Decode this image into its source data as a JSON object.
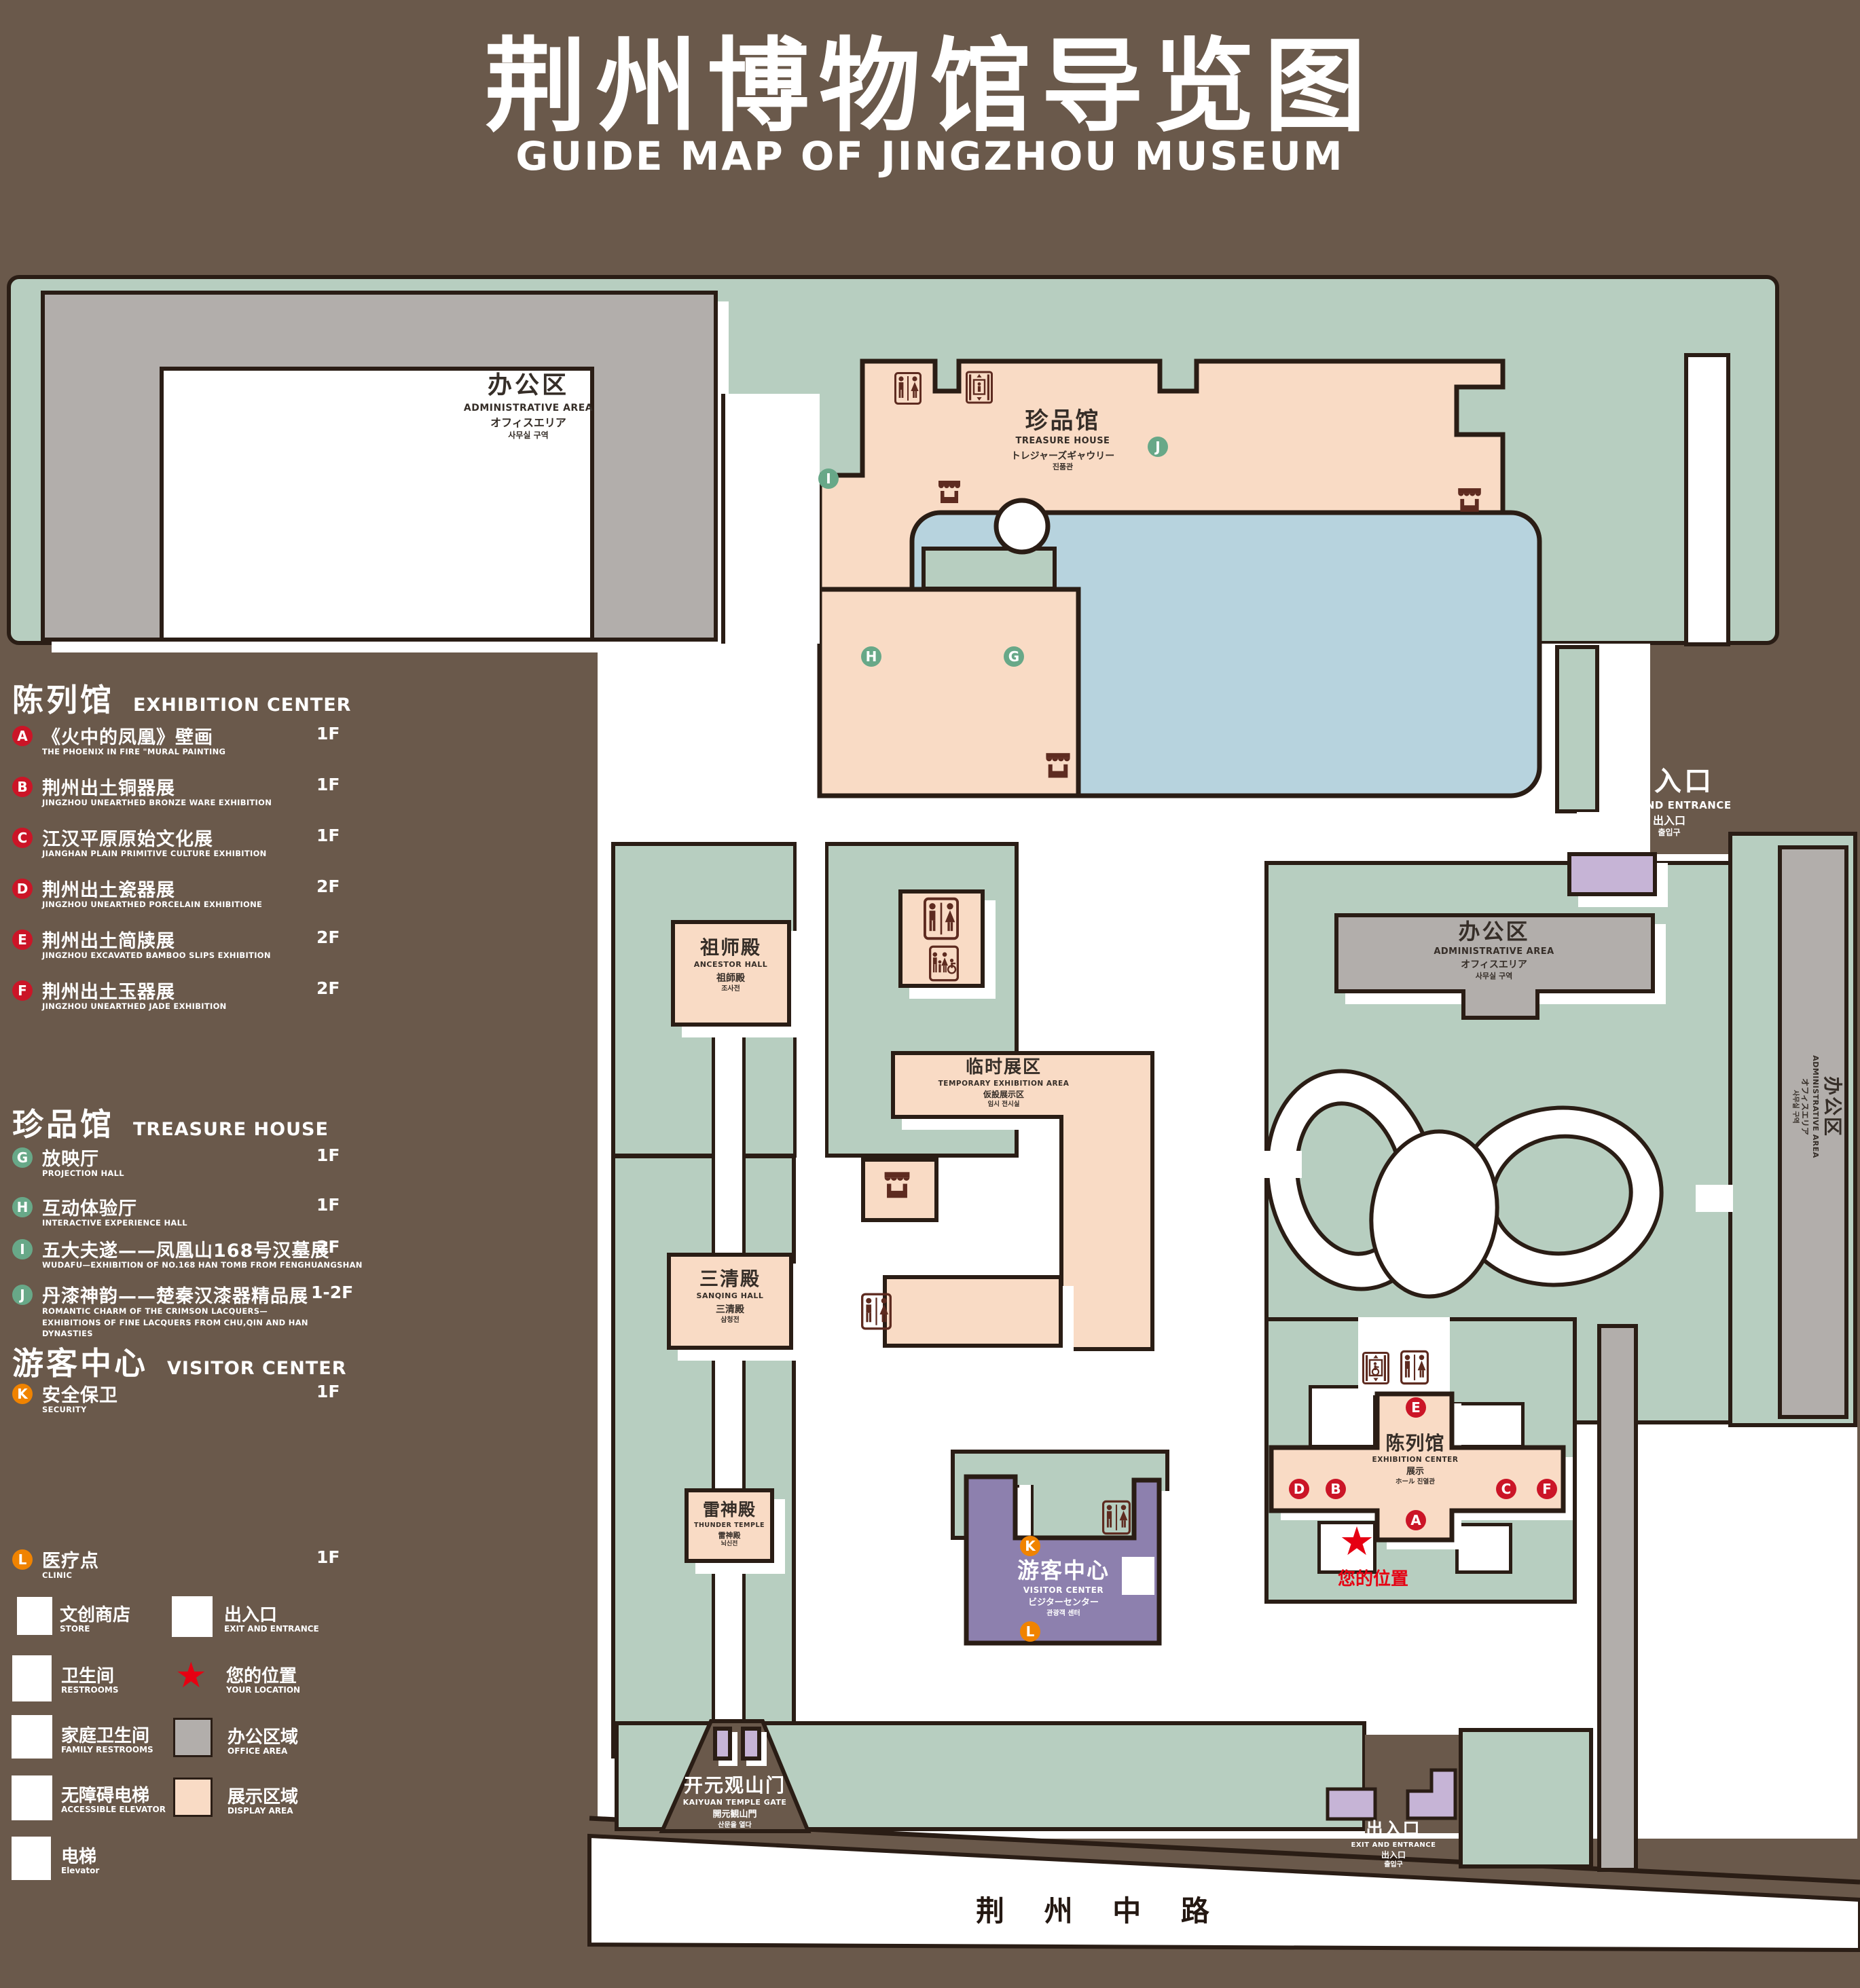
{
  "title": {
    "zh": "荆州博物馆导览图",
    "en": "GUIDE MAP OF JINGZHOU MUSEUM"
  },
  "colors": {
    "background": "#6a594b",
    "grounds_green": "#b7cec0",
    "display_area_pink": "#f9dbc5",
    "office_area_gray": "#b2aeab",
    "pond_blue": "#b7d3de",
    "visitor_center_purple": "#8d80ae",
    "gate_purple": "#c6b4d6",
    "marker_red": "#cb1527",
    "marker_green": "#68a888",
    "marker_orange": "#f08300",
    "icon_maroon": "#5e2b20",
    "location_star_red": "#e60012",
    "outline": "#2a1d15"
  },
  "legend": {
    "sections": [
      {
        "title_zh": "陈列馆",
        "title_en": "EXHIBITION CENTER",
        "items": [
          {
            "id": "A",
            "zh": "《火中的凤凰》壁画",
            "en": "THE PHOENIX IN FIRE \"MURAL PAINTING",
            "floor": "1F"
          },
          {
            "id": "B",
            "zh": "荆州出土铜器展",
            "en": "JINGZHOU UNEARTHED BRONZE WARE EXHIBITION",
            "floor": "1F"
          },
          {
            "id": "C",
            "zh": "江汉平原原始文化展",
            "en": "JIANGHAN PLAIN PRIMITIVE CULTURE EXHIBITION",
            "floor": "1F"
          },
          {
            "id": "D",
            "zh": "荆州出土瓷器展",
            "en": "JINGZHOU UNEARTHED PORCELAIN EXHIBITIONE",
            "floor": "2F"
          },
          {
            "id": "E",
            "zh": "荆州出土简牍展",
            "en": "JINGZHOU EXCAVATED BAMBOO SLIPS EXHIBITION",
            "floor": "2F"
          },
          {
            "id": "F",
            "zh": "荆州出土玉器展",
            "en": "JINGZHOU UNEARTHED JADE EXHIBITION",
            "floor": "2F"
          }
        ]
      },
      {
        "title_zh": "珍品馆",
        "title_en": "TREASURE HOUSE",
        "items": [
          {
            "id": "G",
            "zh": "放映厅",
            "en": "PROJECTION HALL",
            "floor": "1F"
          },
          {
            "id": "H",
            "zh": "互动体验厅",
            "en": "INTERACTIVE EXPERIENCE HALL",
            "floor": "1F"
          },
          {
            "id": "I",
            "zh": "五大夫遂——凤凰山168号汉墓展",
            "en": "WUDAFU—EXHIBITION OF NO.168 HAN TOMB FROM FENGHUANGSHAN",
            "floor": "2F"
          },
          {
            "id": "J",
            "zh": "丹漆神韵——楚秦汉漆器精品展",
            "en": "ROMANTIC CHARM OF THE CRIMSON LACQUERS—EXHIBITIONS OF FINE LACQUERS FROM CHU,QIN AND HAN DYNASTIES",
            "floor": "1-2F"
          }
        ]
      },
      {
        "title_zh": "游客中心",
        "title_en": "VISITOR CENTER",
        "items": [
          {
            "id": "K",
            "zh": "安全保卫",
            "en": "SECURITY",
            "floor": "1F"
          },
          {
            "id": "L",
            "zh": "医疗点",
            "en": "CLINIC",
            "floor": "1F"
          }
        ]
      }
    ],
    "symbols": [
      {
        "zh": "文创商店",
        "en": "STORE",
        "icon": "store-icon"
      },
      {
        "zh": "卫生间",
        "en": "RESTROOMS",
        "icon": "restroom-icon"
      },
      {
        "zh": "家庭卫生间",
        "en": "FAMILY RESTROOMS",
        "icon": "family-restroom-icon"
      },
      {
        "zh": "无障碍电梯",
        "en": "ACCESSIBLE ELEVATOR",
        "icon": "accessible-elevator-icon"
      },
      {
        "zh": "电梯",
        "en": "Elevator",
        "icon": "elevator-icon"
      },
      {
        "zh": "出入口",
        "en": "EXIT AND ENTRANCE",
        "icon": "exit-icon"
      },
      {
        "zh": "您的位置",
        "en": "YOUR LOCATION",
        "icon": "location-star-icon"
      },
      {
        "zh": "办公区域",
        "en": "OFFICE AREA",
        "icon": "office-swatch"
      },
      {
        "zh": "展示区域",
        "en": "DISPLAY AREA",
        "icon": "display-swatch"
      }
    ]
  },
  "map": {
    "admin": {
      "zh": "办公区",
      "en": "ADMINISTRATIVE AREA",
      "ja": "オフィスエリア",
      "ko": "사무실 구역"
    },
    "treasure": {
      "zh": "珍品馆",
      "en": "TREASURE HOUSE",
      "ja": "トレジャーズギャウリー",
      "ko": "진품관"
    },
    "exit": {
      "zh": "出入口",
      "en": "EXIT AND ENTRANCE",
      "zh2": "出入口",
      "ko": "출입구"
    },
    "ancestor": {
      "zh": "祖师殿",
      "en": "ANCESTOR HALL",
      "ja": "祖師殿",
      "ko": "조사전"
    },
    "temp": {
      "zh": "临时展区",
      "en": "TEMPORARY EXHIBITION AREA",
      "ja": "仮設展示区",
      "ko": "임시 전시실"
    },
    "sanqing": {
      "zh": "三清殿",
      "en": "SANQING HALL",
      "ja": "三清殿",
      "ko": "삼청전"
    },
    "thunder": {
      "zh": "雷神殿",
      "en": "THUNDER TEMPLE",
      "ja": "雷神殿",
      "ko": "뇌신전"
    },
    "visitor": {
      "zh": "游客中心",
      "en": "VISITOR CENTER",
      "ja": "ビジターセンター",
      "ko": "관광객 센터"
    },
    "exhibition": {
      "zh": "陈列馆",
      "en": "EXHIBITION CENTER",
      "ja": "展示",
      "ko": "ホール 진열관"
    },
    "gate": {
      "zh": "开元观山门",
      "en": "KAIYUAN TEMPLE GATE",
      "ja": "開元観山門",
      "ko": "산문을 열다"
    },
    "road": "荆 州 中 路",
    "your_location": "您的位置",
    "markers": {
      "a": "A",
      "b": "B",
      "c": "C",
      "d": "D",
      "e": "E",
      "f": "F",
      "g": "G",
      "h": "H",
      "i": "I",
      "j": "J",
      "k": "K",
      "l": "L"
    }
  }
}
